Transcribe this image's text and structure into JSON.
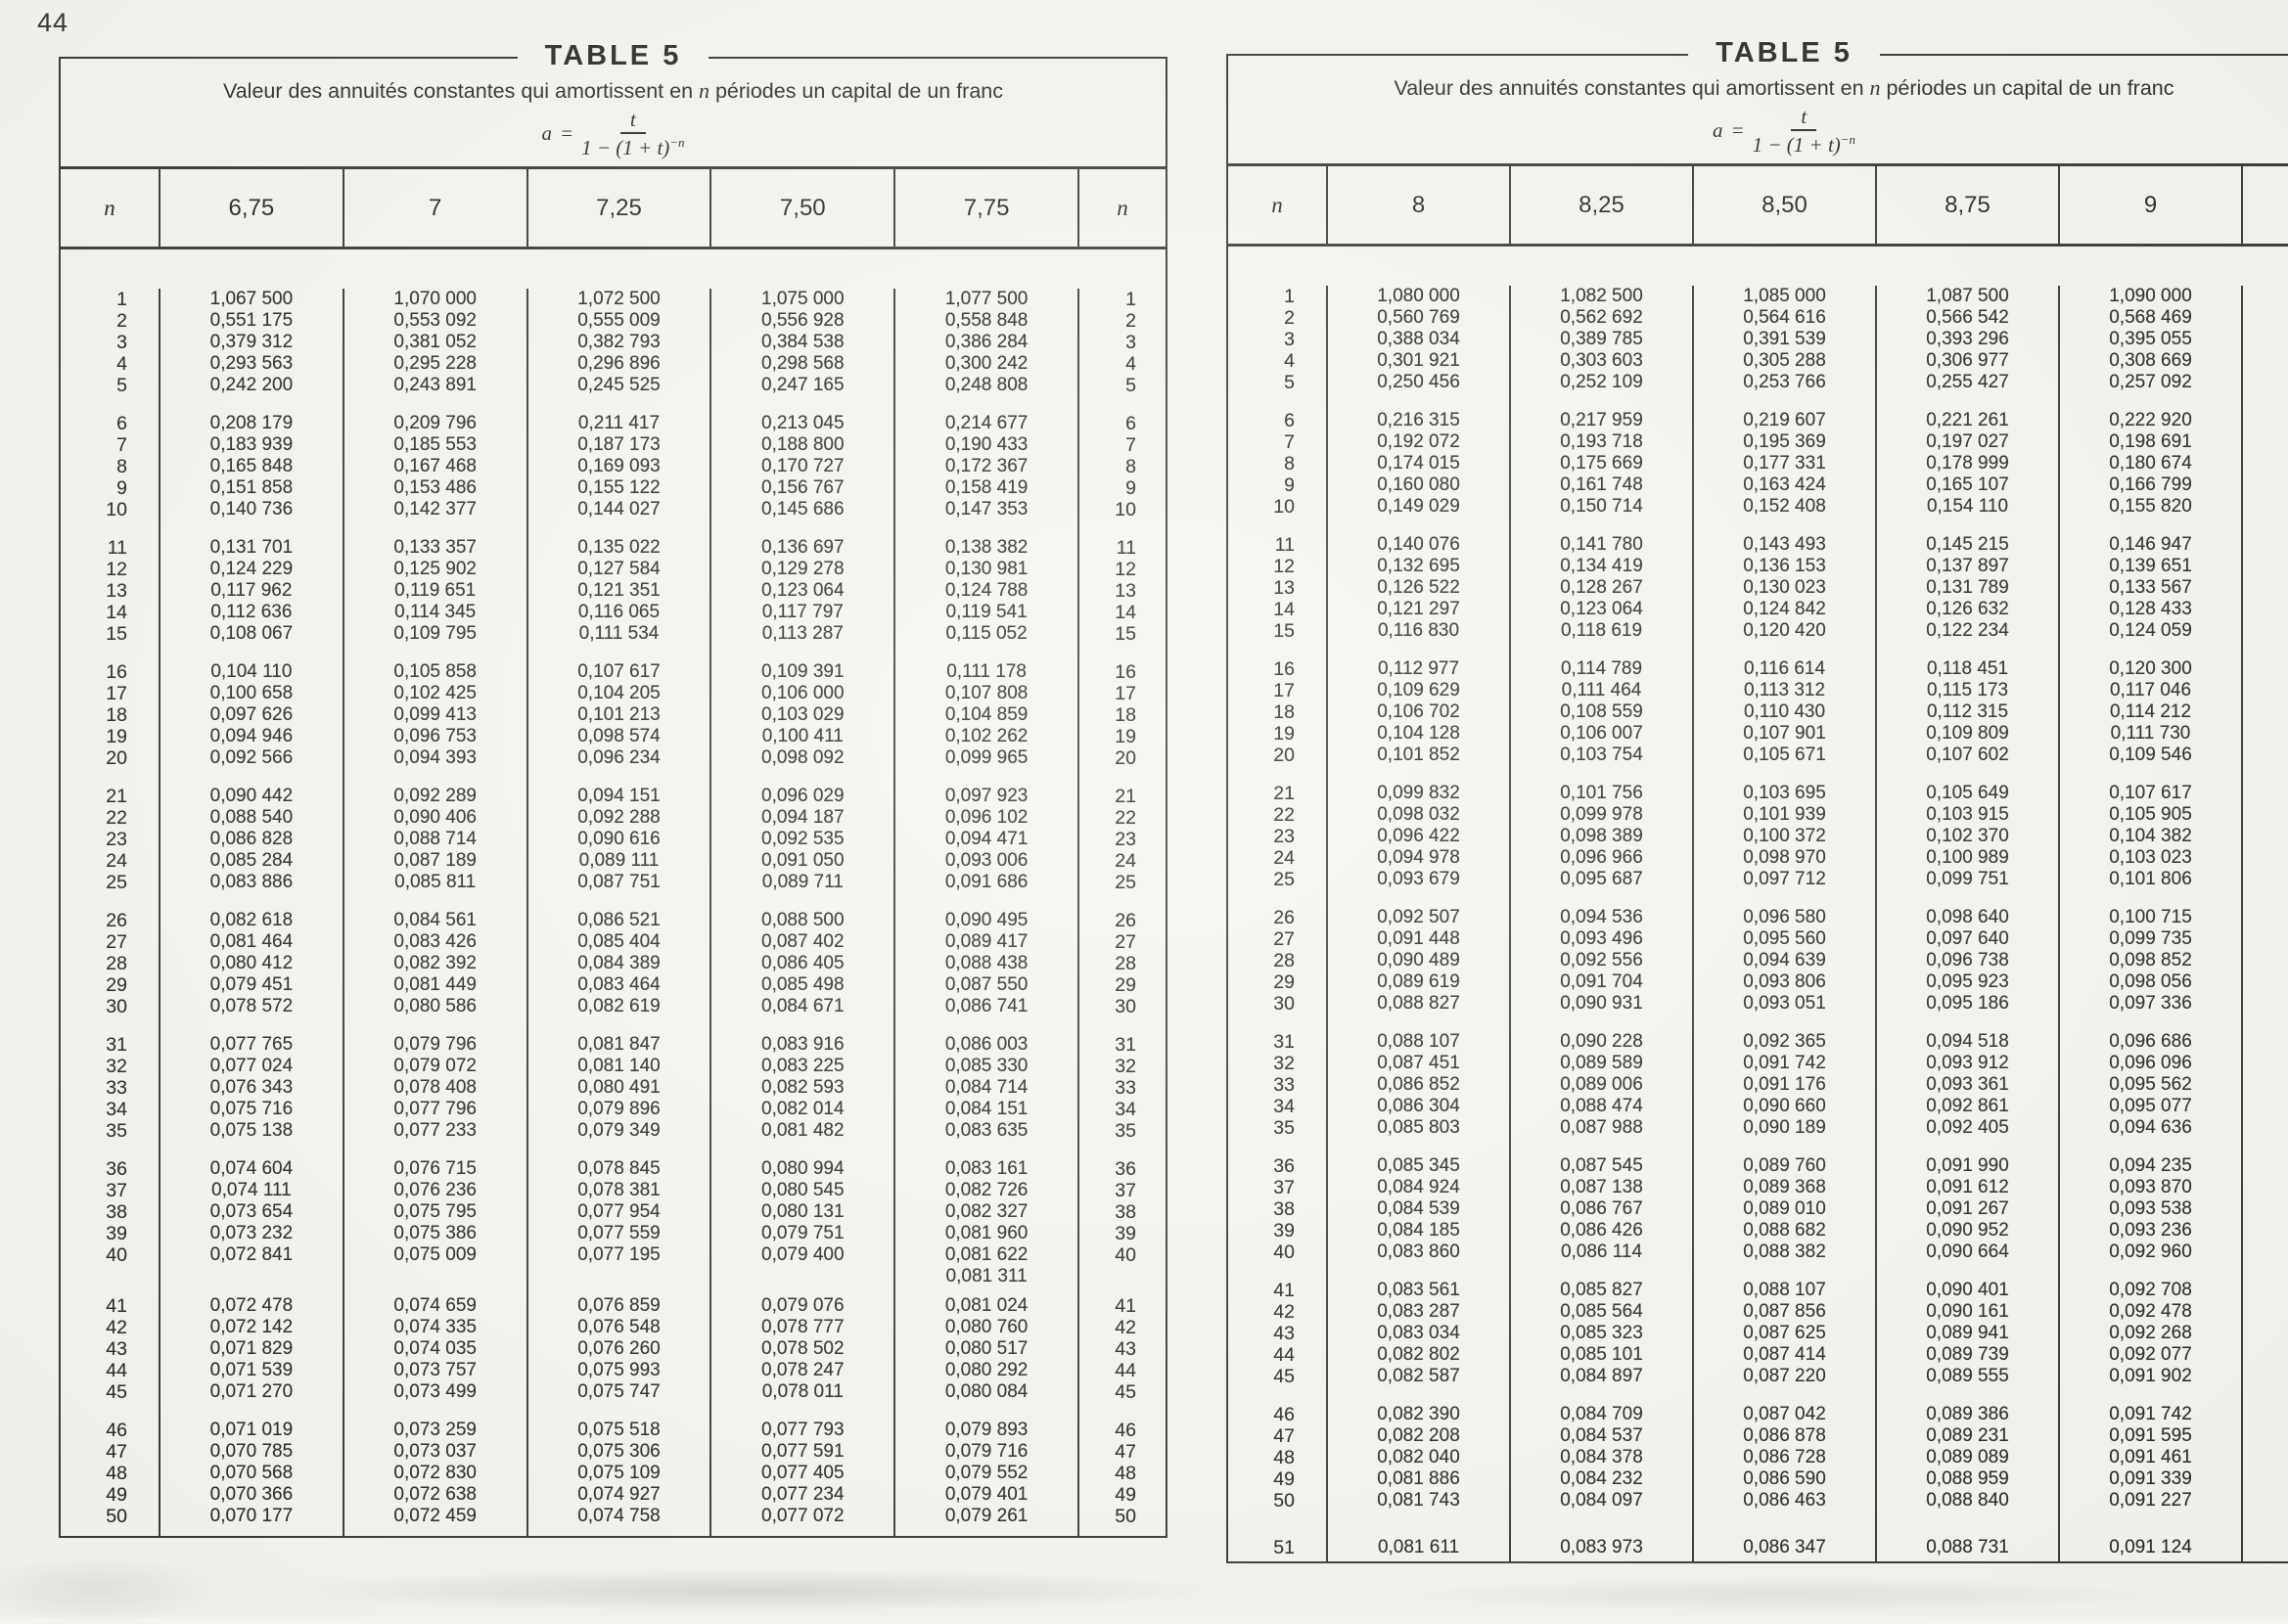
{
  "page": {
    "number": "44"
  },
  "table_left": {
    "heading": "TABLE 5",
    "title_pre": "Valeur des annuités constantes qui amortissent en ",
    "title_var": "n",
    "title_post": " périodes un capital de un franc",
    "formula": {
      "lhs": "a",
      "equals": "=",
      "numerator": "t",
      "den_base": "1 − (1 + t)",
      "den_exp": "−n"
    },
    "n_label_left": "n",
    "n_label_right": "n",
    "show_right_n": true,
    "rate_headers": [
      "6,75",
      "7",
      "7,25",
      "7,50",
      "7,75"
    ],
    "rows": [
      {
        "n": "1",
        "v": [
          "1,067 500",
          "1,070 000",
          "1,072 500",
          "1,075 000",
          "1,077 500"
        ]
      },
      {
        "n": "2",
        "v": [
          "0,551 175",
          "0,553 092",
          "0,555 009",
          "0,556 928",
          "0,558 848"
        ]
      },
      {
        "n": "3",
        "v": [
          "0,379 312",
          "0,381 052",
          "0,382 793",
          "0,384 538",
          "0,386 284"
        ]
      },
      {
        "n": "4",
        "v": [
          "0,293 563",
          "0,295 228",
          "0,296 896",
          "0,298 568",
          "0,300 242"
        ]
      },
      {
        "n": "5",
        "v": [
          "0,242 200",
          "0,243 891",
          "0,245 525",
          "0,247 165",
          "0,248 808"
        ],
        "g": 17
      },
      {
        "n": "6",
        "v": [
          "0,208 179",
          "0,209 796",
          "0,211 417",
          "0,213 045",
          "0,214 677"
        ]
      },
      {
        "n": "7",
        "v": [
          "0,183 939",
          "0,185 553",
          "0,187 173",
          "0,188 800",
          "0,190 433"
        ]
      },
      {
        "n": "8",
        "v": [
          "0,165 848",
          "0,167 468",
          "0,169 093",
          "0,170 727",
          "0,172 367"
        ]
      },
      {
        "n": "9",
        "v": [
          "0,151 858",
          "0,153 486",
          "0,155 122",
          "0,156 767",
          "0,158 419"
        ]
      },
      {
        "n": "10",
        "v": [
          "0,140 736",
          "0,142 377",
          "0,144 027",
          "0,145 686",
          "0,147 353"
        ],
        "g": 17
      },
      {
        "n": "11",
        "v": [
          "0,131 701",
          "0,133 357",
          "0,135 022",
          "0,136 697",
          "0,138 382"
        ]
      },
      {
        "n": "12",
        "v": [
          "0,124 229",
          "0,125 902",
          "0,127 584",
          "0,129 278",
          "0,130 981"
        ]
      },
      {
        "n": "13",
        "v": [
          "0,117 962",
          "0,119 651",
          "0,121 351",
          "0,123 064",
          "0,124 788"
        ]
      },
      {
        "n": "14",
        "v": [
          "0,112 636",
          "0,114 345",
          "0,116 065",
          "0,117 797",
          "0,119 541"
        ]
      },
      {
        "n": "15",
        "v": [
          "0,108 067",
          "0,109 795",
          "0,111 534",
          "0,113 287",
          "0,115 052"
        ],
        "g": 17
      },
      {
        "n": "16",
        "v": [
          "0,104 110",
          "0,105 858",
          "0,107 617",
          "0,109 391",
          "0,111 178"
        ]
      },
      {
        "n": "17",
        "v": [
          "0,100 658",
          "0,102 425",
          "0,104 205",
          "0,106 000",
          "0,107 808"
        ]
      },
      {
        "n": "18",
        "v": [
          "0,097 626",
          "0,099 413",
          "0,101 213",
          "0,103 029",
          "0,104 859"
        ]
      },
      {
        "n": "19",
        "v": [
          "0,094 946",
          "0,096 753",
          "0,098 574",
          "0,100 411",
          "0,102 262"
        ]
      },
      {
        "n": "20",
        "v": [
          "0,092 566",
          "0,094 393",
          "0,096 234",
          "0,098 092",
          "0,099 965"
        ],
        "g": 17
      },
      {
        "n": "21",
        "v": [
          "0,090 442",
          "0,092 289",
          "0,094 151",
          "0,096 029",
          "0,097 923"
        ]
      },
      {
        "n": "22",
        "v": [
          "0,088 540",
          "0,090 406",
          "0,092 288",
          "0,094 187",
          "0,096 102"
        ]
      },
      {
        "n": "23",
        "v": [
          "0,086 828",
          "0,088 714",
          "0,090 616",
          "0,092 535",
          "0,094 471"
        ]
      },
      {
        "n": "24",
        "v": [
          "0,085 284",
          "0,087 189",
          "0,089 111",
          "0,091 050",
          "0,093 006"
        ]
      },
      {
        "n": "25",
        "v": [
          "0,083 886",
          "0,085 811",
          "0,087 751",
          "0,089 711",
          "0,091 686"
        ],
        "g": 17
      },
      {
        "n": "26",
        "v": [
          "0,082 618",
          "0,084 561",
          "0,086 521",
          "0,088 500",
          "0,090 495"
        ]
      },
      {
        "n": "27",
        "v": [
          "0,081 464",
          "0,083 426",
          "0,085 404",
          "0,087 402",
          "0,089 417"
        ]
      },
      {
        "n": "28",
        "v": [
          "0,080 412",
          "0,082 392",
          "0,084 389",
          "0,086 405",
          "0,088 438"
        ]
      },
      {
        "n": "29",
        "v": [
          "0,079 451",
          "0,081 449",
          "0,083 464",
          "0,085 498",
          "0,087 550"
        ]
      },
      {
        "n": "30",
        "v": [
          "0,078 572",
          "0,080 586",
          "0,082 619",
          "0,084 671",
          "0,086 741"
        ],
        "g": 17
      },
      {
        "n": "31",
        "v": [
          "0,077 765",
          "0,079 796",
          "0,081 847",
          "0,083 916",
          "0,086 003"
        ]
      },
      {
        "n": "32",
        "v": [
          "0,077 024",
          "0,079 072",
          "0,081 140",
          "0,083 225",
          "0,085 330"
        ]
      },
      {
        "n": "33",
        "v": [
          "0,076 343",
          "0,078 408",
          "0,080 491",
          "0,082 593",
          "0,084 714"
        ]
      },
      {
        "n": "34",
        "v": [
          "0,075 716",
          "0,077 796",
          "0,079 896",
          "0,082 014",
          "0,084 151"
        ]
      },
      {
        "n": "35",
        "v": [
          "0,075 138",
          "0,077 233",
          "0,079 349",
          "0,081 482",
          "0,083 635"
        ],
        "g": 17
      },
      {
        "n": "36",
        "v": [
          "0,074 604",
          "0,076 715",
          "0,078 845",
          "0,080 994",
          "0,083 161"
        ]
      },
      {
        "n": "37",
        "v": [
          "0,074 111",
          "0,076 236",
          "0,078 381",
          "0,080 545",
          "0,082 726"
        ]
      },
      {
        "n": "38",
        "v": [
          "0,073 654",
          "0,075 795",
          "0,077 954",
          "0,080 131",
          "0,082 327"
        ]
      },
      {
        "n": "39",
        "v": [
          "0,073 232",
          "0,075 386",
          "0,077 559",
          "0,079 751",
          "0,081 960"
        ]
      },
      {
        "n": "40",
        "v": [
          "0,072 841",
          "0,075 009",
          "0,077 195",
          "0,079 400",
          "0,081 622"
        ]
      },
      {
        "n": "",
        "v": [
          "",
          "",
          "",
          "",
          "0,081 311"
        ],
        "extra": true,
        "g": 8
      },
      {
        "n": "41",
        "v": [
          "0,072 478",
          "0,074 659",
          "0,076 859",
          "0,079 076",
          "0,081 024"
        ]
      },
      {
        "n": "42",
        "v": [
          "0,072 142",
          "0,074 335",
          "0,076 548",
          "0,078 777",
          "0,080 760"
        ]
      },
      {
        "n": "43",
        "v": [
          "0,071 829",
          "0,074 035",
          "0,076 260",
          "0,078 502",
          "0,080 517"
        ]
      },
      {
        "n": "44",
        "v": [
          "0,071 539",
          "0,073 757",
          "0,075 993",
          "0,078 247",
          "0,080 292"
        ]
      },
      {
        "n": "45",
        "v": [
          "0,071 270",
          "0,073 499",
          "0,075 747",
          "0,078 011",
          "0,080 084"
        ],
        "g": 17
      },
      {
        "n": "46",
        "v": [
          "0,071 019",
          "0,073 259",
          "0,075 518",
          "0,077 793",
          "0,079 893"
        ]
      },
      {
        "n": "47",
        "v": [
          "0,070 785",
          "0,073 037",
          "0,075 306",
          "0,077 591",
          "0,079 716"
        ]
      },
      {
        "n": "48",
        "v": [
          "0,070 568",
          "0,072 830",
          "0,075 109",
          "0,077 405",
          "0,079 552"
        ]
      },
      {
        "n": "49",
        "v": [
          "0,070 366",
          "0,072 638",
          "0,074 927",
          "0,077 234",
          "0,079 401"
        ]
      },
      {
        "n": "50",
        "v": [
          "0,070 177",
          "0,072 459",
          "0,074 758",
          "0,077 072",
          "0,079 261"
        ]
      }
    ]
  },
  "table_right": {
    "heading": "TABLE 5",
    "title_pre": "Valeur des annuités constantes qui amortissent en ",
    "title_var": "n",
    "title_post": " périodes un capital de un franc",
    "formula": {
      "lhs": "a",
      "equals": "=",
      "numerator": "t",
      "den_base": "1 − (1 + t)",
      "den_exp": "−n"
    },
    "n_label_left": "n",
    "n_label_right": "",
    "show_right_n": false,
    "rate_headers": [
      "8",
      "8,25",
      "8,50",
      "8,75",
      "9"
    ],
    "rows": [
      {
        "n": "1",
        "v": [
          "1,080 000",
          "1,082 500",
          "1,085 000",
          "1,087 500",
          "1,090 000"
        ]
      },
      {
        "n": "2",
        "v": [
          "0,560 769",
          "0,562 692",
          "0,564 616",
          "0,566 542",
          "0,568 469"
        ]
      },
      {
        "n": "3",
        "v": [
          "0,388 034",
          "0,389 785",
          "0,391 539",
          "0,393 296",
          "0,395 055"
        ]
      },
      {
        "n": "4",
        "v": [
          "0,301 921",
          "0,303 603",
          "0,305 288",
          "0,306 977",
          "0,308 669"
        ]
      },
      {
        "n": "5",
        "v": [
          "0,250 456",
          "0,252 109",
          "0,253 766",
          "0,255 427",
          "0,257 092"
        ],
        "g": 17
      },
      {
        "n": "6",
        "v": [
          "0,216 315",
          "0,217 959",
          "0,219 607",
          "0,221 261",
          "0,222 920"
        ]
      },
      {
        "n": "7",
        "v": [
          "0,192 072",
          "0,193 718",
          "0,195 369",
          "0,197 027",
          "0,198 691"
        ]
      },
      {
        "n": "8",
        "v": [
          "0,174 015",
          "0,175 669",
          "0,177 331",
          "0,178 999",
          "0,180 674"
        ]
      },
      {
        "n": "9",
        "v": [
          "0,160 080",
          "0,161 748",
          "0,163 424",
          "0,165 107",
          "0,166 799"
        ]
      },
      {
        "n": "10",
        "v": [
          "0,149 029",
          "0,150 714",
          "0,152 408",
          "0,154 110",
          "0,155 820"
        ],
        "g": 17
      },
      {
        "n": "11",
        "v": [
          "0,140 076",
          "0,141 780",
          "0,143 493",
          "0,145 215",
          "0,146 947"
        ]
      },
      {
        "n": "12",
        "v": [
          "0,132 695",
          "0,134 419",
          "0,136 153",
          "0,137 897",
          "0,139 651"
        ]
      },
      {
        "n": "13",
        "v": [
          "0,126 522",
          "0,128 267",
          "0,130 023",
          "0,131 789",
          "0,133 567"
        ]
      },
      {
        "n": "14",
        "v": [
          "0,121 297",
          "0,123 064",
          "0,124 842",
          "0,126 632",
          "0,128 433"
        ]
      },
      {
        "n": "15",
        "v": [
          "0,116 830",
          "0,118 619",
          "0,120 420",
          "0,122 234",
          "0,124 059"
        ],
        "g": 17
      },
      {
        "n": "16",
        "v": [
          "0,112 977",
          "0,114 789",
          "0,116 614",
          "0,118 451",
          "0,120 300"
        ]
      },
      {
        "n": "17",
        "v": [
          "0,109 629",
          "0,111 464",
          "0,113 312",
          "0,115 173",
          "0,117 046"
        ]
      },
      {
        "n": "18",
        "v": [
          "0,106 702",
          "0,108 559",
          "0,110 430",
          "0,112 315",
          "0,114 212"
        ]
      },
      {
        "n": "19",
        "v": [
          "0,104 128",
          "0,106 007",
          "0,107 901",
          "0,109 809",
          "0,111 730"
        ]
      },
      {
        "n": "20",
        "v": [
          "0,101 852",
          "0,103 754",
          "0,105 671",
          "0,107 602",
          "0,109 546"
        ],
        "g": 17
      },
      {
        "n": "21",
        "v": [
          "0,099 832",
          "0,101 756",
          "0,103 695",
          "0,105 649",
          "0,107 617"
        ]
      },
      {
        "n": "22",
        "v": [
          "0,098 032",
          "0,099 978",
          "0,101 939",
          "0,103 915",
          "0,105 905"
        ]
      },
      {
        "n": "23",
        "v": [
          "0,096 422",
          "0,098 389",
          "0,100 372",
          "0,102 370",
          "0,104 382"
        ]
      },
      {
        "n": "24",
        "v": [
          "0,094 978",
          "0,096 966",
          "0,098 970",
          "0,100 989",
          "0,103 023"
        ]
      },
      {
        "n": "25",
        "v": [
          "0,093 679",
          "0,095 687",
          "0,097 712",
          "0,099 751",
          "0,101 806"
        ],
        "g": 17
      },
      {
        "n": "26",
        "v": [
          "0,092 507",
          "0,094 536",
          "0,096 580",
          "0,098 640",
          "0,100 715"
        ]
      },
      {
        "n": "27",
        "v": [
          "0,091 448",
          "0,093 496",
          "0,095 560",
          "0,097 640",
          "0,099 735"
        ]
      },
      {
        "n": "28",
        "v": [
          "0,090 489",
          "0,092 556",
          "0,094 639",
          "0,096 738",
          "0,098 852"
        ]
      },
      {
        "n": "29",
        "v": [
          "0,089 619",
          "0,091 704",
          "0,093 806",
          "0,095 923",
          "0,098 056"
        ]
      },
      {
        "n": "30",
        "v": [
          "0,088 827",
          "0,090 931",
          "0,093 051",
          "0,095 186",
          "0,097 336"
        ],
        "g": 17
      },
      {
        "n": "31",
        "v": [
          "0,088 107",
          "0,090 228",
          "0,092 365",
          "0,094 518",
          "0,096 686"
        ]
      },
      {
        "n": "32",
        "v": [
          "0,087 451",
          "0,089 589",
          "0,091 742",
          "0,093 912",
          "0,096 096"
        ]
      },
      {
        "n": "33",
        "v": [
          "0,086 852",
          "0,089 006",
          "0,091 176",
          "0,093 361",
          "0,095 562"
        ]
      },
      {
        "n": "34",
        "v": [
          "0,086 304",
          "0,088 474",
          "0,090 660",
          "0,092 861",
          "0,095 077"
        ]
      },
      {
        "n": "35",
        "v": [
          "0,085 803",
          "0,087 988",
          "0,090 189",
          "0,092 405",
          "0,094 636"
        ],
        "g": 17
      },
      {
        "n": "36",
        "v": [
          "0,085 345",
          "0,087 545",
          "0,089 760",
          "0,091 990",
          "0,094 235"
        ]
      },
      {
        "n": "37",
        "v": [
          "0,084 924",
          "0,087 138",
          "0,089 368",
          "0,091 612",
          "0,093 870"
        ]
      },
      {
        "n": "38",
        "v": [
          "0,084 539",
          "0,086 767",
          "0,089 010",
          "0,091 267",
          "0,093 538"
        ]
      },
      {
        "n": "39",
        "v": [
          "0,084 185",
          "0,086 426",
          "0,088 682",
          "0,090 952",
          "0,093 236"
        ]
      },
      {
        "n": "40",
        "v": [
          "0,083 860",
          "0,086 114",
          "0,088 382",
          "0,090 664",
          "0,092 960"
        ],
        "g": 17
      },
      {
        "n": "41",
        "v": [
          "0,083 561",
          "0,085 827",
          "0,088 107",
          "0,090 401",
          "0,092 708"
        ]
      },
      {
        "n": "42",
        "v": [
          "0,083 287",
          "0,085 564",
          "0,087 856",
          "0,090 161",
          "0,092 478"
        ]
      },
      {
        "n": "43",
        "v": [
          "0,083 034",
          "0,085 323",
          "0,087 625",
          "0,089 941",
          "0,092 268"
        ]
      },
      {
        "n": "44",
        "v": [
          "0,082 802",
          "0,085 101",
          "0,087 414",
          "0,089 739",
          "0,092 077"
        ]
      },
      {
        "n": "45",
        "v": [
          "0,082 587",
          "0,084 897",
          "0,087 220",
          "0,089 555",
          "0,091 902"
        ],
        "g": 17
      },
      {
        "n": "46",
        "v": [
          "0,082 390",
          "0,084 709",
          "0,087 042",
          "0,089 386",
          "0,091 742"
        ]
      },
      {
        "n": "47",
        "v": [
          "0,082 208",
          "0,084 537",
          "0,086 878",
          "0,089 231",
          "0,091 595"
        ]
      },
      {
        "n": "48",
        "v": [
          "0,082 040",
          "0,084 378",
          "0,086 728",
          "0,089 089",
          "0,091 461"
        ]
      },
      {
        "n": "49",
        "v": [
          "0,081 886",
          "0,084 232",
          "0,086 590",
          "0,088 959",
          "0,091 339"
        ]
      },
      {
        "n": "50",
        "v": [
          "0,081 743",
          "0,084 097",
          "0,086 463",
          "0,088 840",
          "0,091 227"
        ],
        "g": 26
      },
      {
        "n": "51",
        "v": [
          "0,081 611",
          "0,083 973",
          "0,086 347",
          "0,088 731",
          "0,091 124"
        ]
      }
    ]
  }
}
